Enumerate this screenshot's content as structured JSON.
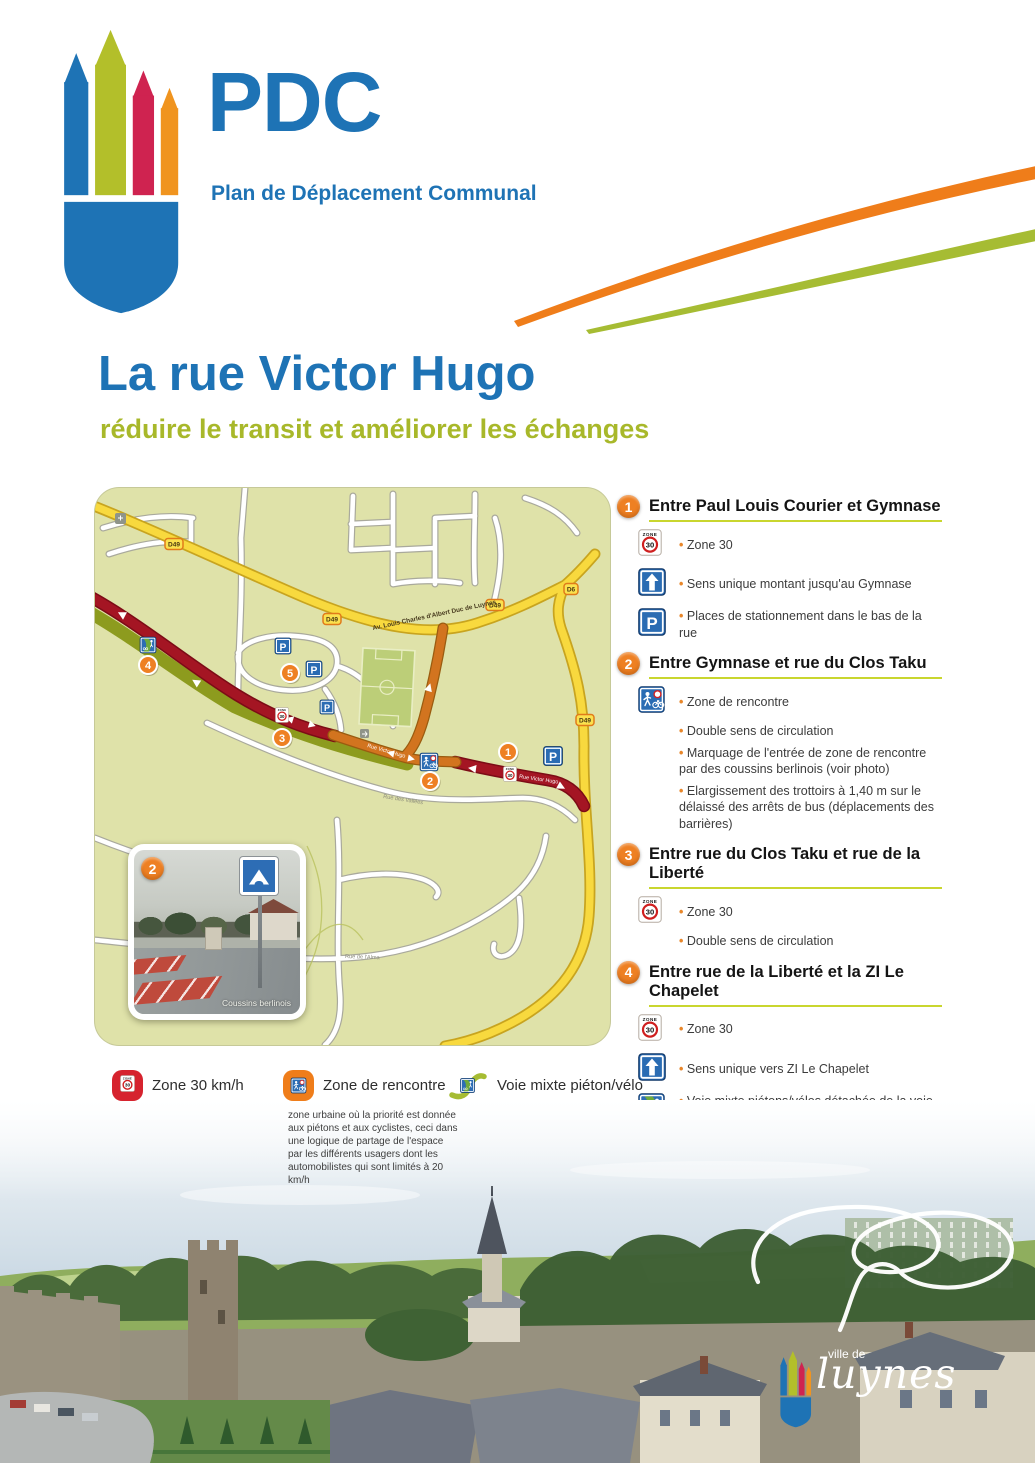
{
  "header": {
    "logo_title": "PDC",
    "logo_subtitle": "Plan de Déplacement Communal"
  },
  "title": {
    "main": "La rue Victor Hugo",
    "subtitle": "réduire le transit et améliorer les échanges"
  },
  "signs": {
    "zone_word": "ZONE",
    "speed": "30",
    "parking": "P"
  },
  "map": {
    "badges": [
      "D49",
      "D49",
      "D49",
      "D6",
      "D49"
    ],
    "labels": {
      "avenue": "Av. Louis Charles d'Albert Duc de Luynes",
      "victor_hugo_upper": "Rue Victor Hugo",
      "victor_hugo_lower": "Rue Victor Hugo",
      "vallees": "Rue des Vallées",
      "alma": "Rue de l'Alma"
    },
    "markers": [
      "1",
      "2",
      "3",
      "4",
      "5"
    ],
    "photo": {
      "marker": "2",
      "caption": "Coussins berlinois"
    }
  },
  "sections": [
    {
      "number": "1",
      "title": "Entre Paul Louis Courier et Gymnase",
      "items": [
        {
          "icon": "zone-30-sign",
          "text": "Zone 30"
        },
        {
          "icon": "one-way-sign",
          "text": "Sens unique montant jusqu'au Gymnase"
        },
        {
          "icon": "parking-sign",
          "text": "Places de stationnement dans le bas de la rue"
        }
      ]
    },
    {
      "number": "2",
      "title": "Entre Gymnase et rue du Clos Taku",
      "items": [
        {
          "icon": "meeting-zone-sign",
          "text": "Zone de rencontre"
        },
        {
          "icon": "",
          "text": "Double sens de circulation"
        },
        {
          "icon": "",
          "text": "Marquage de l'entrée de zone de rencontre par des coussins berlinois (voir photo)"
        },
        {
          "icon": "",
          "text": "Elargissement des trottoirs à 1,40 m sur le délaissé des arrêts de bus (déplacements des barrières)"
        }
      ]
    },
    {
      "number": "3",
      "title": "Entre rue du Clos Taku et rue de la Liberté",
      "items": [
        {
          "icon": "zone-30-sign",
          "text": "Zone 30"
        },
        {
          "icon": "",
          "text": "Double sens de circulation"
        }
      ]
    },
    {
      "number": "4",
      "title": "Entre rue de la Liberté et la ZI Le Chapelet",
      "items": [
        {
          "icon": "zone-30-sign",
          "text": "Zone 30"
        },
        {
          "icon": "one-way-sign",
          "text": "Sens unique vers ZI Le Chapelet"
        },
        {
          "icon": "mixed-path-sign",
          "text": "Voie mixte piétons/vélos détachée de la voie par protection végétale"
        }
      ]
    },
    {
      "number": "5",
      "title": "Les Trois Pieds de Noyers",
      "items": [
        {
          "icon": "",
          "text": "Modification des sens de circulation"
        },
        {
          "icon": "",
          "text": "Rétrécissement de la rue Jean Boidron"
        },
        {
          "icon": "parking-sign",
          "text": "Places de stationnement en chicanne pour réduire la vitesse de circulation"
        }
      ]
    }
  ],
  "legend": {
    "items": [
      {
        "icon": "zone-30-legend-icon",
        "label": "Zone 30 km/h"
      },
      {
        "icon": "meeting-zone-legend-icon",
        "label": "Zone de rencontre"
      },
      {
        "icon": "mixed-path-legend-icon",
        "label": "Voie mixte piéton/vélo"
      }
    ],
    "note": "zone urbaine où la priorité est donnée aux piétons et aux cyclistes, ceci dans une logique de partage de l'espace par les différents usagers dont les automobilistes qui sont limités à 20 km/h"
  },
  "footer": {
    "brand_top": "ville de",
    "brand_name": "luynes"
  },
  "colors": {
    "blue": "#1e73b5",
    "olive": "#a8b82a",
    "orange": "#ee8023",
    "crimson": "#cf2350",
    "map_bg": "#dfe2a9",
    "road_yellow": "#f8d93e",
    "road_red": "#a41523",
    "road_orange": "#d2741f",
    "sign_blue": "#2a6cb3",
    "legend_red": "#d6232e"
  }
}
